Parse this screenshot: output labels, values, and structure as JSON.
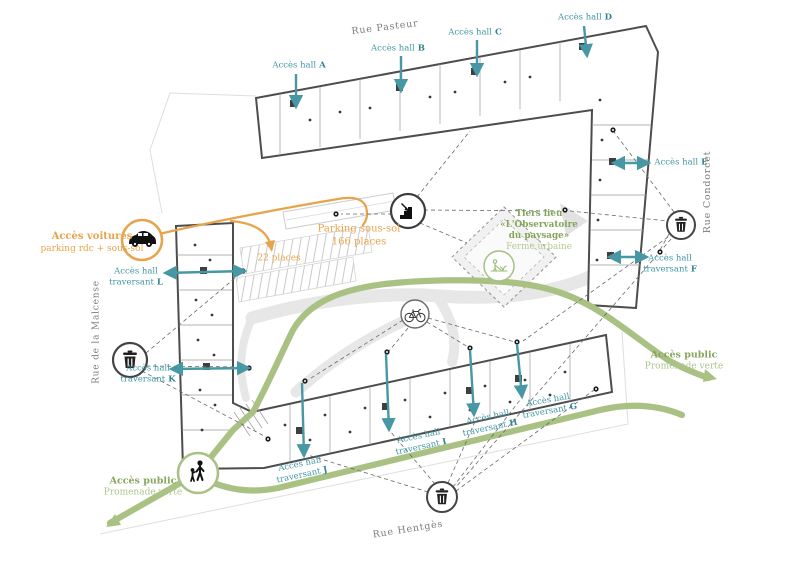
{
  "streets": {
    "top": "Rue Pasteur",
    "right": "Rue Condorcet",
    "left": "Rue de la Malcense",
    "bottom": "Rue Hentgès"
  },
  "halls": {
    "a": {
      "prefix": "Accès hall",
      "letter": "A"
    },
    "b": {
      "prefix": "Accès hall",
      "letter": "B"
    },
    "c": {
      "prefix": "Accès hall",
      "letter": "C"
    },
    "d": {
      "prefix": "Accès hall",
      "letter": "D"
    },
    "e": {
      "prefix": "Accès hall",
      "letter": "E"
    }
  },
  "traversant": {
    "f": {
      "line1": "Accès hall",
      "line2": "traversant",
      "letter": "F"
    },
    "g": {
      "line1": "Accès hall",
      "line2": "traversant",
      "letter": "G"
    },
    "h": {
      "line1": "Accès hall",
      "line2": "traversant",
      "letter": "H"
    },
    "i": {
      "line1": "Accès hall",
      "line2": "traversant",
      "letter": "I"
    },
    "j": {
      "line1": "Accès hall",
      "line2": "traversant",
      "letter": "J"
    },
    "k": {
      "line1": "Accès hall",
      "line2": "traversant",
      "letter": "K"
    },
    "l": {
      "line1": "Accès hall",
      "line2": "traversant",
      "letter": "L"
    }
  },
  "car_access": {
    "line1": "Accès voitures",
    "line2": "parking rdc + sous-sol"
  },
  "parking": {
    "line1": "Parking sous-sol",
    "line2": "166 places",
    "small": "22 places"
  },
  "tiers_lieu": {
    "line1": "Tiers lieu",
    "line2": "«L'Observatoire",
    "line3": "du paysage»",
    "line4": "Ferme urbaine"
  },
  "promenade_left": {
    "line1": "Accès public",
    "line2": "Promenade verte"
  },
  "promenade_right": {
    "line1": "Accès public",
    "line2": "Promenade verte"
  },
  "colors": {
    "teal": "#3e96a2",
    "orange": "#e8a44c",
    "green_path": "#a9c284",
    "green_text_bold": "#87a55c",
    "green_text_light": "#aec48a",
    "wall_gray": "#4d4d4d",
    "street_text": "#7c7c7c"
  }
}
